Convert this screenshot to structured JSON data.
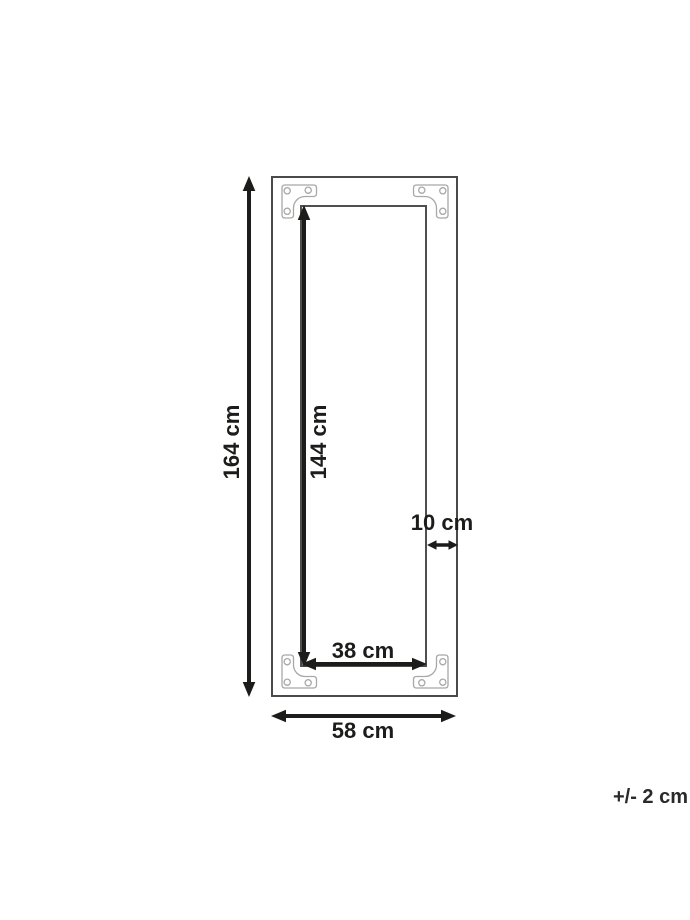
{
  "page": {
    "background": "#ffffff",
    "description": "Product dimension drawing of a rectangular frame with four metal corner brackets"
  },
  "diagram": {
    "labels": {
      "outer_height": "164 cm",
      "inner_height": "144 cm",
      "inner_width": "38 cm",
      "outer_width": "58 cm",
      "frame_width": "10 cm",
      "tolerance": "+/- 2 cm"
    },
    "icons": {
      "corner_bracket": "corner-bracket-icon",
      "double_arrow": "double-arrow-icon"
    },
    "colors": {
      "background": "#ffffff",
      "frame_line": "#4a4a49",
      "bracket_line": "#a8a8a7",
      "dimension_ink": "#1c1c1b"
    }
  }
}
